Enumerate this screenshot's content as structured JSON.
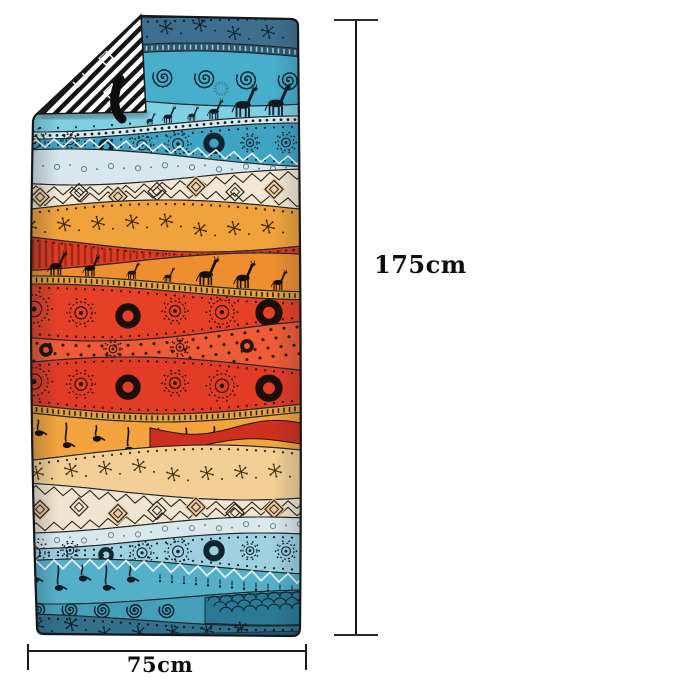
{
  "annotations": {
    "height_label": "175cm",
    "width_label": "75cm"
  },
  "dimensions": {
    "height_cm": 175,
    "width_cm": 75
  },
  "style": {
    "background": "#ffffff",
    "dim_line_color": "#1b1b1b",
    "label_color": "#0f0f0f",
    "towel_outline": "#14181b",
    "ink": "#141414"
  },
  "towel": {
    "description": "boho ethnic-print beach towel with wavy pattern bands, folded top-left corner showing black-white geometric reverse side and a black hanging loop",
    "fold": {
      "stripe_black": "#161616",
      "stripe_white": "#ffffff"
    },
    "loop_color": "#0d0d0d",
    "bands": [
      {
        "name": "top-steel-stars",
        "color": "#3E6F8E",
        "motif": "stars",
        "motif_color": "#102534"
      },
      {
        "name": "dash-ribbon",
        "color": "#2C5972",
        "motif": "ribbon-dashes",
        "motif_color": "#A9CBD8"
      },
      {
        "name": "spirals-teal",
        "color": "#47AECB",
        "motif": "spirals",
        "motif_color": "#0F2430"
      },
      {
        "name": "giraffes-cyan",
        "color": "#7FD0E2",
        "motif": "giraffes",
        "motif_color": "#0D1C24"
      },
      {
        "name": "dotted-ribbon",
        "color": "#D8EAF0",
        "motif": "dots",
        "motif_color": "#15272F"
      },
      {
        "name": "suns-teal",
        "color": "#3FA3C2",
        "motif": "mandalas",
        "motif_color": "#0F2430",
        "accent": "#E6F3F6"
      },
      {
        "name": "pale-wave",
        "color": "#D8E7EC",
        "motif": "small-circles",
        "motif_color": "#5F808D"
      },
      {
        "name": "cream-diamonds",
        "color": "#F2E7D3",
        "motif": "diamonds",
        "motif_color": "#2B241C",
        "accent": "#EACDA5"
      },
      {
        "name": "orange-meadow",
        "color": "#F0A23C",
        "motif": "stars",
        "motif_color": "#3A2206"
      },
      {
        "name": "red-stripes",
        "color": "#DC3D25",
        "motif": "stripes",
        "motif_color": "#A22715"
      },
      {
        "name": "orange-giraffes",
        "color": "#EE8E2F",
        "motif": "giraffes",
        "motif_color": "#160D05"
      },
      {
        "name": "gold-ribbon",
        "color": "#E2A33B",
        "motif": "ribbon-dashes",
        "motif_color": "#20180A"
      },
      {
        "name": "red-mandalas",
        "color": "#E64127",
        "motif": "mandalas",
        "motif_color": "#1C0F08"
      },
      {
        "name": "red-dotted",
        "color": "#EF5B36",
        "motif": "dots",
        "motif_color": "#241008"
      },
      {
        "name": "red-mandalas-2",
        "color": "#E23B26",
        "motif": "mandalas",
        "motif_color": "#1C0F08"
      },
      {
        "name": "gold-ribbon-2",
        "color": "#E2A33B",
        "motif": "ribbon-dashes",
        "motif_color": "#20180A"
      },
      {
        "name": "orange-birds",
        "color": "#F4A43E",
        "motif": "note-birds",
        "motif_color": "#140C04",
        "accent2": "#CE2F1F"
      },
      {
        "name": "tan-meadow",
        "color": "#F2CF96",
        "motif": "stars",
        "motif_color": "#46320E"
      },
      {
        "name": "cream-diamonds-2",
        "color": "#F0E5D0",
        "motif": "diamonds",
        "motif_color": "#2B241C",
        "accent": "#E9C8A2"
      },
      {
        "name": "pale-wave-2",
        "color": "#DAE8EB",
        "motif": "small-circles",
        "motif_color": "#6A8A96"
      },
      {
        "name": "blue-mandalas",
        "color": "#9FD0DF",
        "motif": "mandalas",
        "motif_color": "#0F2531"
      },
      {
        "name": "teal-zigzag-birds",
        "color": "#54AFC9",
        "motif": "note-birds",
        "motif_color": "#0C1D26",
        "accent": "#DFF0F4"
      },
      {
        "name": "teal-spirals",
        "color": "#459FBB",
        "motif": "spirals",
        "motif_color": "#0E2430",
        "accent": "#2B7A95"
      },
      {
        "name": "bottom-steel-stars",
        "color": "#32708C",
        "motif": "stars",
        "motif_color": "#0C1E29",
        "accent": "#27566F"
      }
    ]
  }
}
